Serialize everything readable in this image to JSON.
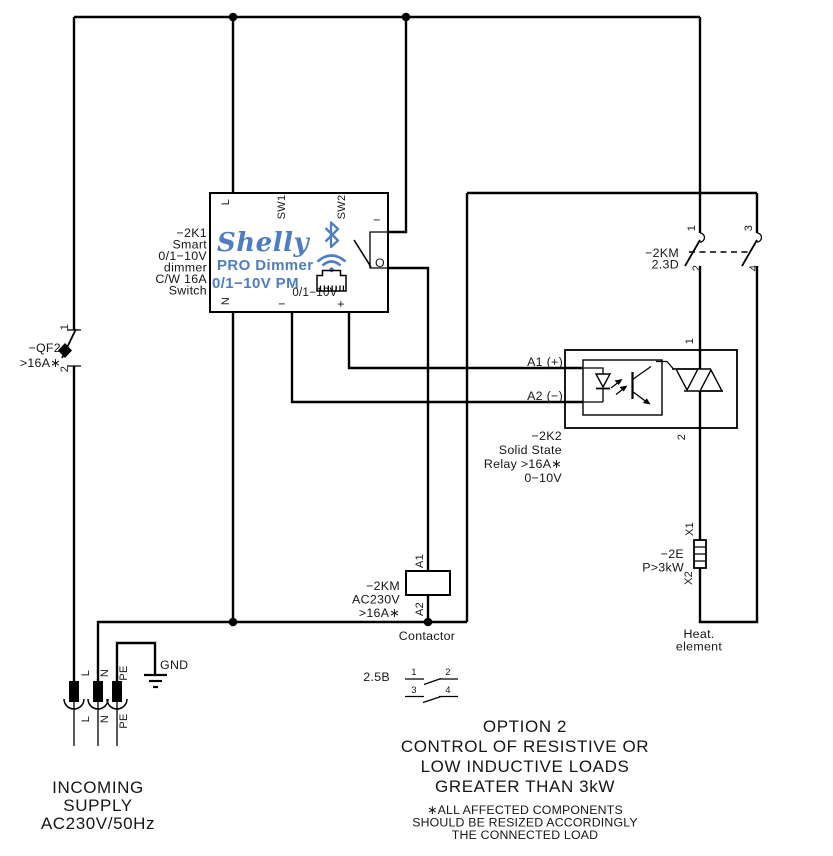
{
  "colors": {
    "wire": "#000000",
    "brand_blue": "#4f7dc3"
  },
  "supply": {
    "lines": [
      "INCOMING",
      "SUPPLY",
      "AC230V/50Hz"
    ],
    "terminals_top": [
      "L",
      "N",
      "PE"
    ],
    "terminals_bottom": [
      "L",
      "N",
      "PE"
    ],
    "ground": "GND"
  },
  "breaker": {
    "name": "−QF2",
    "rating": ">16A∗",
    "t1": "1",
    "t2": "2"
  },
  "dimmer": {
    "desc": [
      "−2K1",
      "Smart",
      "0/1−10V",
      "dimmer",
      "C/W 16A",
      "Switch"
    ],
    "brand": "Shelly",
    "product": "PRO Dimmer",
    "model": "0/1−10V PM",
    "term_l": "L",
    "term_n": "N",
    "sw1": "SW1",
    "sw2": "SW2",
    "out_on": "−",
    "out_o": "O",
    "analog": "0/1−10V",
    "analog_minus": "−",
    "analog_plus": "+",
    "icons": [
      "bluetooth-icon",
      "wifi-icon",
      "ethernet-port-icon"
    ]
  },
  "km_contacts": {
    "name": "−2KM",
    "ref": "2.3D",
    "t1": "1",
    "t2": "2",
    "t3": "3",
    "t4": "4"
  },
  "ssr": {
    "a1": "A1 (+)",
    "a2": "A2 (−)",
    "t1": "1",
    "t2": "2",
    "desc": [
      "−2K2",
      "Solid State",
      "Relay >16A∗",
      "0−10V"
    ]
  },
  "contactor": {
    "name": "−2KM",
    "voltage": "AC230V",
    "rating": ">16A∗",
    "a1": "A1",
    "a2": "A2",
    "caption": "Contactor",
    "ref": "2.5B",
    "aux": [
      "1",
      "2",
      "3",
      "4"
    ]
  },
  "heater": {
    "name": "−2E",
    "power": "P>3kW",
    "x1": "X1",
    "x2": "X2",
    "caption1": "Heat.",
    "caption2": "element"
  },
  "option": {
    "title": "OPTION 2",
    "lines": [
      "CONTROL OF RESISTIVE OR",
      "LOW INDUCTIVE LOADS",
      "GREATER THAN 3kW"
    ],
    "notes": [
      "∗ALL AFFECTED COMPONENTS",
      "SHOULD BE RESIZED ACCORDINGLY",
      "THE CONNECTED LOAD"
    ]
  }
}
